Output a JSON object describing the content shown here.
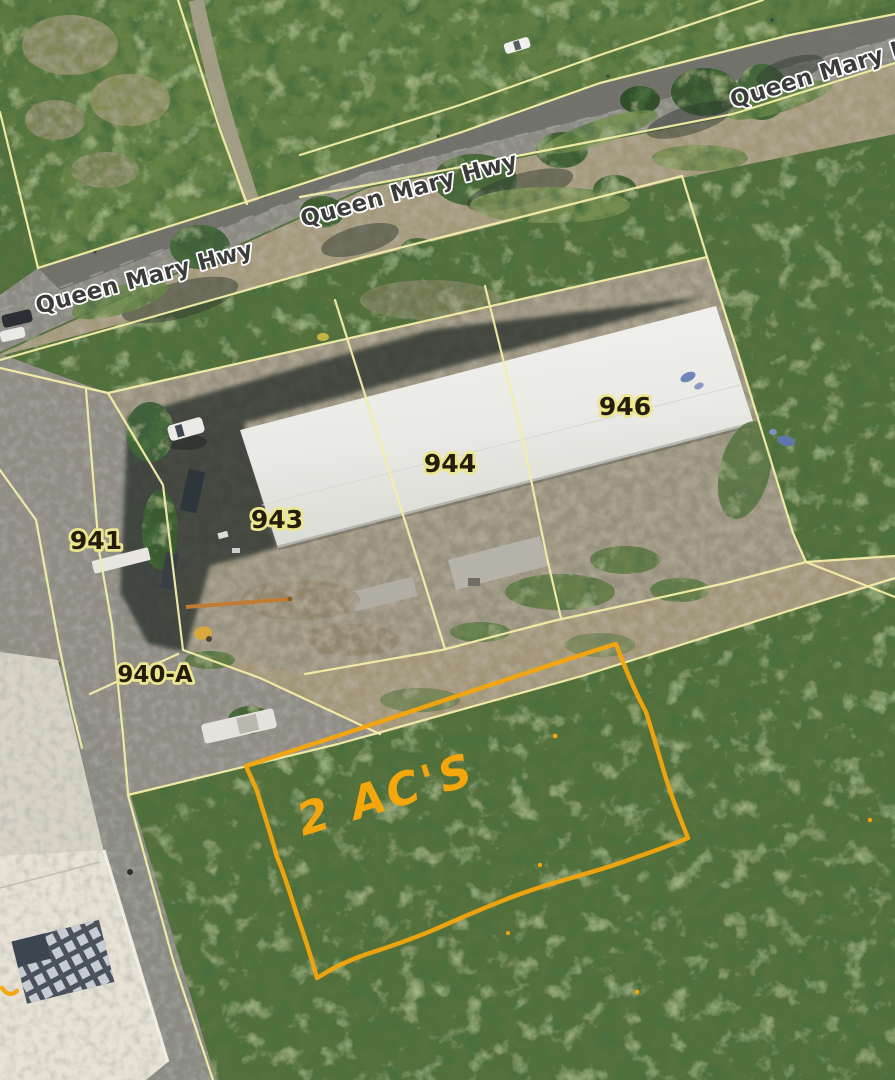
{
  "map": {
    "description": "Aerial parcel map, Queen Mary Hwy",
    "road_labels": [
      {
        "id": "left",
        "text": "Queen Mary Hwy"
      },
      {
        "id": "center",
        "text": "Queen Mary Hwy"
      },
      {
        "id": "top-right",
        "text": "Queen Mary Hwy"
      }
    ],
    "parcel_labels": [
      {
        "id": "941",
        "text": "941"
      },
      {
        "id": "943",
        "text": "943"
      },
      {
        "id": "944",
        "text": "944"
      },
      {
        "id": "946",
        "text": "946"
      },
      {
        "id": "940-A",
        "text": "940-A"
      }
    ],
    "annotation": {
      "text": "2 AC'S"
    },
    "colors": {
      "parcel_line": "#f3eea6",
      "annotation": "#f4a60d",
      "road_label_text": "#3b3b3b",
      "road_label_halo": "#ffffff",
      "parcel_label_text": "#241d0e",
      "parcel_label_halo": "#ece78f"
    }
  }
}
